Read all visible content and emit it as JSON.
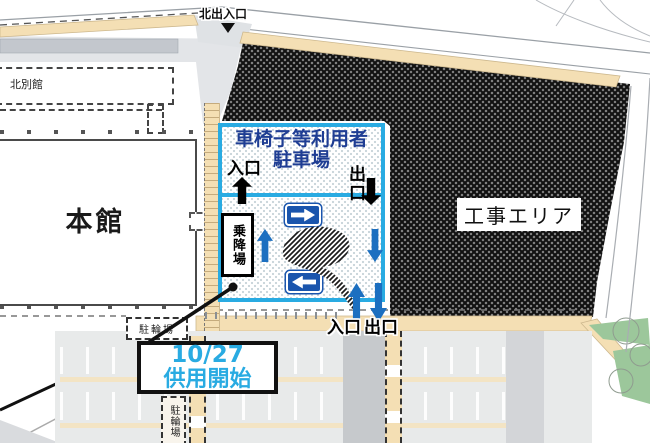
{
  "labels": {
    "north_gate": "北出入口",
    "north_annex": "北別館",
    "main_building": "本館",
    "construction_area": "工事エリア",
    "bicycle_parking_a": "駐輪場",
    "bicycle_parking_b": "駐輪場"
  },
  "parking": {
    "title_line1": "車椅子等利用者",
    "title_line2": "駐車場",
    "top_entrance": "入口",
    "top_exit": "出口",
    "boarding_area": "乗降場",
    "bottom_entrance": "入口",
    "bottom_exit": "出口"
  },
  "callout": {
    "date": "10/27",
    "text": "供用開始"
  },
  "colors": {
    "accent_cyan": "#29abe2",
    "title_navy": "#1e3d93",
    "arrow_blue": "#1c6fc0",
    "sign_blue": "#1a55ad",
    "path_beige": "#f4dfb4",
    "construction_dark": "#1a1a1a",
    "lot_gray": "#e8eaea",
    "green": "#9cc79b"
  }
}
